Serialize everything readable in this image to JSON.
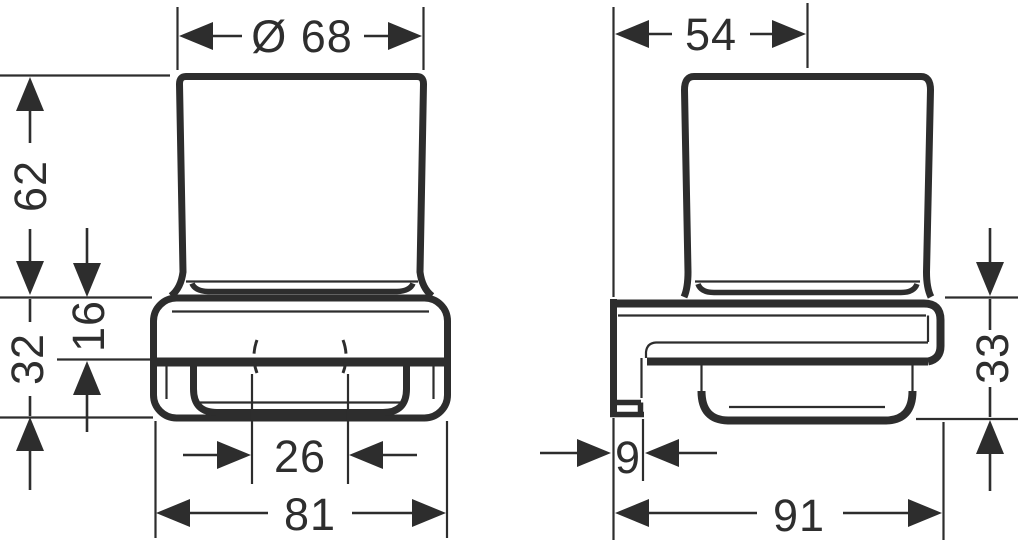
{
  "drawing": {
    "background": "#ffffff",
    "line_color": "#2d2d2d",
    "front_view": {
      "name": "front-view",
      "dims": {
        "glass_diameter": "Ø 68",
        "glass_height_above_holder": "62",
        "holder_height": "32",
        "holder_rim_height": "16",
        "drain_hole_diameter": "26",
        "holder_width": "81"
      }
    },
    "side_view": {
      "name": "side-view",
      "dims": {
        "wall_to_glass_axis": "54",
        "wall_plate_depth": "9",
        "overall_depth": "91",
        "holder_front_height": "33"
      }
    }
  }
}
